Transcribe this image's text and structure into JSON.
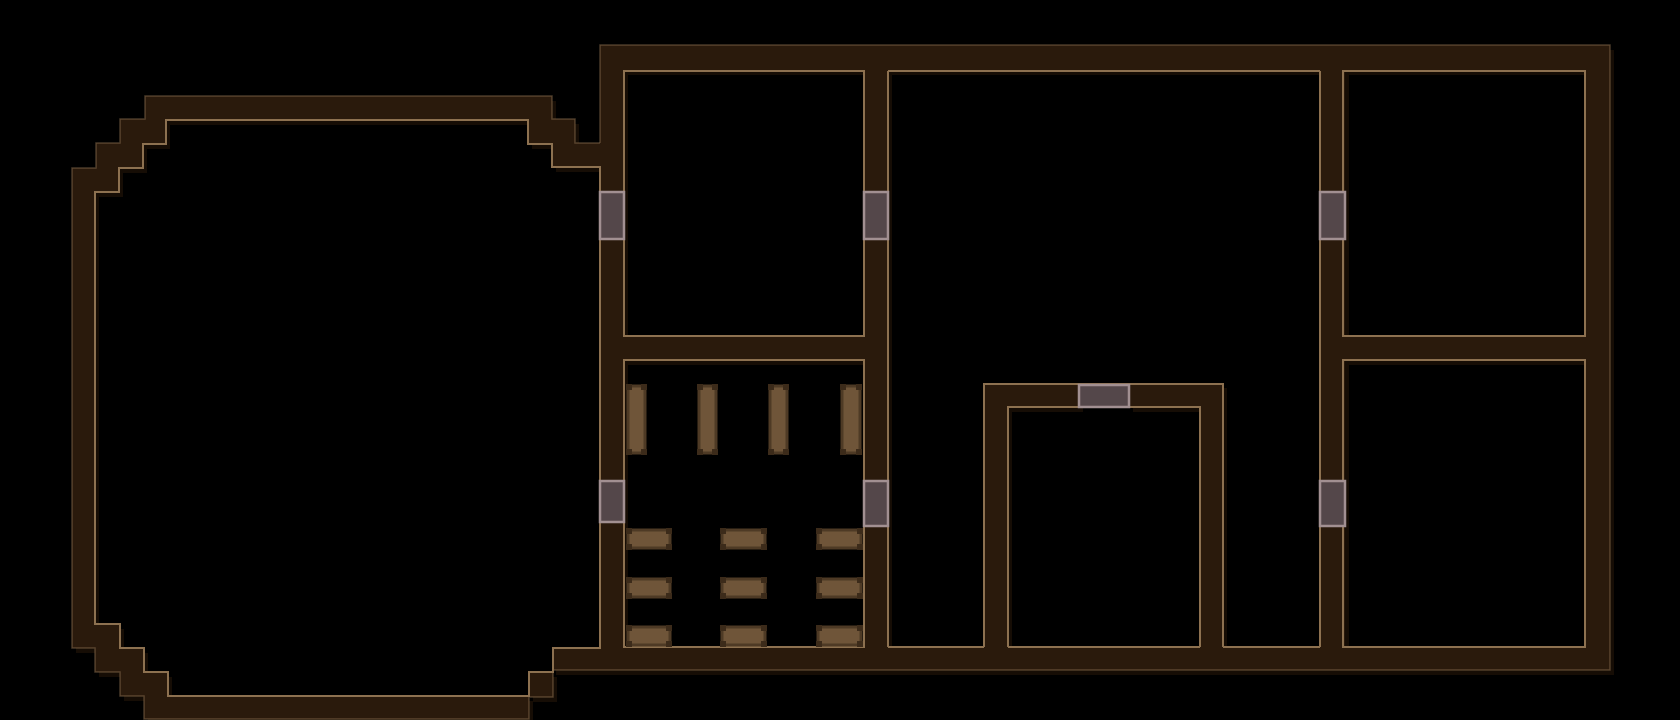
{
  "canvas": {
    "width": 1680,
    "height": 720
  },
  "colors": {
    "background": "#000000",
    "wall_fill": "#2a1a0c",
    "outline_inner": "#8d7150",
    "outline_outer": "rgba(141,113,80,0.5)",
    "door_fill": "#54474a",
    "door_border": "#a29092",
    "bench_fill": "#6f5539",
    "bench_border": "#4e3a25",
    "bench_cap": "#3c2b1a",
    "shadow": "#160d05"
  },
  "walls": {
    "fill_paths": [
      {
        "name": "octagon-hall-walls",
        "d": "M145,96 L552,96 L552,119 L575,119 L575,143 L612,143 L612,670 L553,670 L553,697 L529,697 L529,719 L144,719 L144,696 L120,696 L120,672 L95,672 L95,648 L72,648 L72,168 L96,168 L96,143 L120,143 L120,119 L145,119 Z M166,120 L528,120 L528,144 L552,144 L552,167 L600,167 L600,648 L553,648 L553,672 L529,672 L529,696 L168,696 L168,672 L144,672 L144,648 L120,648 L120,624 L95,624 L95,192 L119,192 L119,168 L143,168 L143,144 L166,144 Z"
      }
    ],
    "fill_rects": [
      {
        "name": "wall-north",
        "x": 600,
        "y": 45,
        "w": 1010,
        "h": 25
      },
      {
        "name": "wall-west",
        "x": 600,
        "y": 45,
        "w": 24,
        "h": 625
      },
      {
        "name": "wall-east",
        "x": 1585,
        "y": 45,
        "w": 25,
        "h": 625
      },
      {
        "name": "wall-south",
        "x": 552,
        "y": 648,
        "w": 1058,
        "h": 22
      },
      {
        "name": "wall-vertical-a",
        "x": 864,
        "y": 70,
        "w": 24,
        "h": 578
      },
      {
        "name": "wall-vertical-b",
        "x": 1320,
        "y": 70,
        "w": 25,
        "h": 578
      },
      {
        "name": "wall-divider-west",
        "x": 600,
        "y": 337,
        "w": 264,
        "h": 23
      },
      {
        "name": "wall-divider-east",
        "x": 1343,
        "y": 337,
        "w": 242,
        "h": 23
      },
      {
        "name": "small-room-wall-west",
        "x": 984,
        "y": 383,
        "w": 24,
        "h": 265
      },
      {
        "name": "small-room-wall-east",
        "x": 1200,
        "y": 383,
        "w": 23,
        "h": 265
      },
      {
        "name": "small-room-wall-north-left",
        "x": 984,
        "y": 383,
        "w": 95,
        "h": 24
      },
      {
        "name": "small-room-wall-north-right",
        "x": 1129,
        "y": 383,
        "w": 94,
        "h": 24
      }
    ],
    "inner_outlines": [
      {
        "name": "octagon-room-outline",
        "d": "M166,120 L528,120 L528,144 L552,144 L552,167 L600,167 L600,648 L553,648 L553,672 L529,672 L529,696 L168,696 L168,672 L144,672 L144,648 L120,648 L120,624 L95,624 L95,192 L119,192 L119,168 L143,168 L143,144 L166,144 Z"
      },
      {
        "name": "room-northwest-outline",
        "d": "M624,71 L864,71 L864,336 L624,336 Z"
      },
      {
        "name": "bench-room-outline",
        "d": "M624,360 L864,360 L864,647 L624,647 Z"
      },
      {
        "name": "middle-room-outline",
        "d": "M888,71 L1320,71 M888,71 L888,647 M1320,71 L1320,647 M888,647 L984,647 M1008,647 L1200,647 M1223,647 L1320,647"
      },
      {
        "name": "small-room-outer-outline",
        "d": "M984,647 L984,384 L1223,384 L1223,647"
      },
      {
        "name": "small-room-inner-outline",
        "d": "M1008,647 L1008,407 L1200,407 L1200,647"
      },
      {
        "name": "room-northeast-outline",
        "d": "M1343,71 L1585,71 L1585,336 L1343,336 Z"
      },
      {
        "name": "room-southeast-outline",
        "d": "M1343,360 L1585,360 L1585,647 L1343,647 Z"
      }
    ],
    "outer_outlines": [
      {
        "name": "octagon-exterior-outline",
        "d": "M600,143 L575,143 L575,119 L552,119 L552,96 L145,96 L145,119 L120,119 L120,143 L96,143 L96,168 L72,168 L72,648 L95,648 L95,672 L120,672 L120,696 L144,696 L144,719 L529,719 L529,697 L553,697 L553,670"
      },
      {
        "name": "building-exterior-outline",
        "d": "M600,143 L600,45 L1610,45 L1610,670 L553,670"
      }
    ]
  },
  "doors": [
    {
      "name": "door-west-wall-north",
      "x": 600,
      "y": 192,
      "w": 24,
      "h": 47
    },
    {
      "name": "door-west-wall-south",
      "x": 600,
      "y": 481,
      "w": 24,
      "h": 41
    },
    {
      "name": "door-wall-a-north",
      "x": 864,
      "y": 192,
      "w": 24,
      "h": 47
    },
    {
      "name": "door-wall-a-south",
      "x": 864,
      "y": 481,
      "w": 24,
      "h": 45
    },
    {
      "name": "door-wall-b-north",
      "x": 1320,
      "y": 192,
      "w": 25,
      "h": 47
    },
    {
      "name": "door-wall-b-south",
      "x": 1320,
      "y": 481,
      "w": 25,
      "h": 45
    },
    {
      "name": "door-small-room-north",
      "x": 1079,
      "y": 385,
      "w": 50,
      "h": 22
    }
  ],
  "benches": [
    {
      "name": "bench-vertical-1",
      "x": 628,
      "y": 386,
      "w": 17,
      "h": 67
    },
    {
      "name": "bench-vertical-2",
      "x": 699,
      "y": 386,
      "w": 17,
      "h": 67
    },
    {
      "name": "bench-vertical-3",
      "x": 770,
      "y": 386,
      "w": 17,
      "h": 67
    },
    {
      "name": "bench-vertical-4",
      "x": 842,
      "y": 386,
      "w": 18,
      "h": 67
    },
    {
      "name": "bench-row1-col1",
      "x": 628,
      "y": 530,
      "w": 42,
      "h": 18
    },
    {
      "name": "bench-row1-col2",
      "x": 722,
      "y": 530,
      "w": 43,
      "h": 18
    },
    {
      "name": "bench-row1-col3",
      "x": 818,
      "y": 530,
      "w": 43,
      "h": 18
    },
    {
      "name": "bench-row2-col1",
      "x": 628,
      "y": 579,
      "w": 42,
      "h": 18
    },
    {
      "name": "bench-row2-col2",
      "x": 722,
      "y": 579,
      "w": 43,
      "h": 18
    },
    {
      "name": "bench-row2-col3",
      "x": 818,
      "y": 579,
      "w": 43,
      "h": 18
    },
    {
      "name": "bench-row3-col1",
      "x": 628,
      "y": 627,
      "w": 42,
      "h": 18
    },
    {
      "name": "bench-row3-col2",
      "x": 722,
      "y": 627,
      "w": 43,
      "h": 18
    },
    {
      "name": "bench-row3-col3",
      "x": 818,
      "y": 627,
      "w": 43,
      "h": 18
    }
  ]
}
